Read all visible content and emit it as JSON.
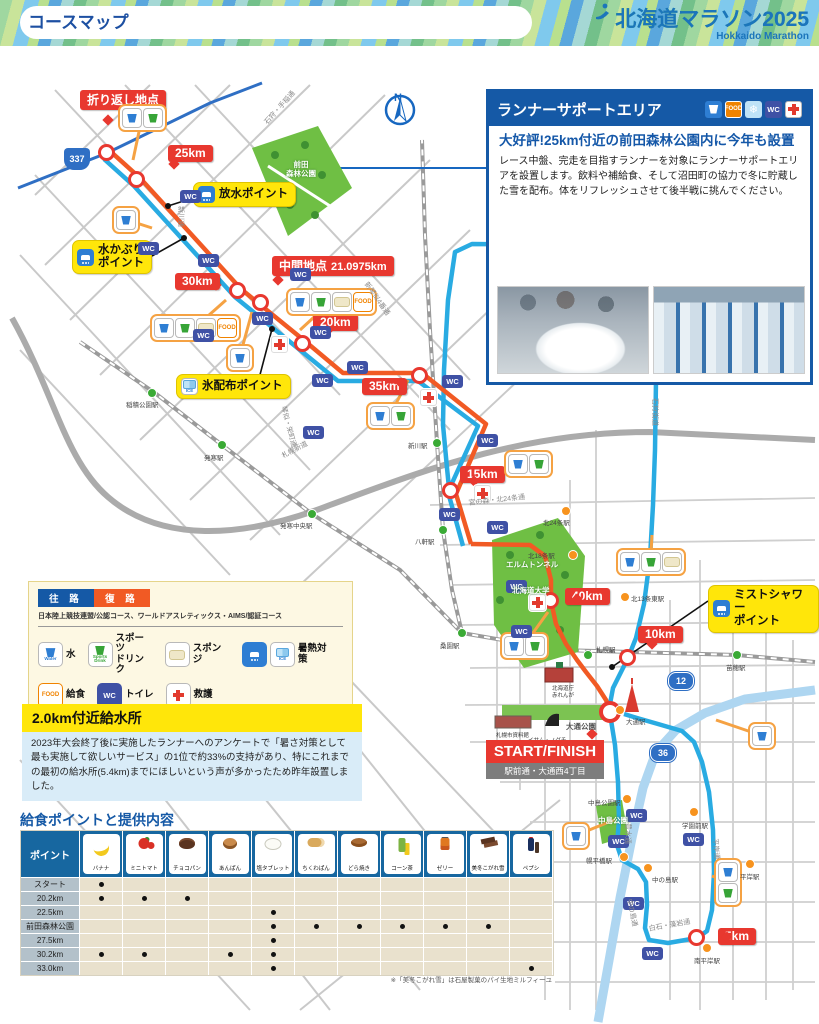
{
  "colors": {
    "course_outbound": "#29abe2",
    "course_return": "#f15a24",
    "marker_red": "#e8382f",
    "brand_blue": "#1559a6",
    "highlight_yellow": "#ffe60a",
    "park_green": "#6fbf44"
  },
  "header": {
    "title": "コースマップ",
    "logo_title": "北海道マラソン2025",
    "logo_subtitle": "Hokkaido Marathon"
  },
  "support_box": {
    "title": "ランナーサポートエリア",
    "headline": "大好評!25km付近の前田森林公園内に今年も設置",
    "body": "レース中盤、完走を目指すランナーを対象にランナーサポートエリアを設置します。飲料や補給食、そして沼田町の協力で冬に貯蔵した雪を配布。体をリフレッシュさせて後半戦に挑んでください。"
  },
  "legend": {
    "outbound_label": "往 路",
    "return_label": "復 路",
    "certification": "日本陸上競技連盟/公認コース、ワールドアスレティックス・AIMS/認証コース",
    "items": [
      {
        "icons": [
          "water"
        ],
        "label": "水"
      },
      {
        "icons": [
          "drink"
        ],
        "label": "スポーツ\nドリンク"
      },
      {
        "icons": [
          "sponge"
        ],
        "label": "スポンジ"
      },
      {
        "icons": [
          "shower",
          "ice"
        ],
        "label": "暑熱対策"
      },
      {
        "icons": [
          "food"
        ],
        "label": "給食"
      },
      {
        "icons": [
          "wc"
        ],
        "label": "トイレ"
      },
      {
        "icons": [
          "aid"
        ],
        "label": "救護"
      }
    ]
  },
  "water_station_box": {
    "title": "2.0km付近給水所",
    "body": "2023年大会終了後に実施したランナーへのアンケートで「暑さ対策として最も実施して欲しいサービス」の1位で約33%の支持があり、特にこれまでの最初の給水所(5.4km)までにほしいという声が多かったため昨年設置しました。"
  },
  "food_table": {
    "title": "給食ポイントと提供内容",
    "point_header": "ポイント",
    "columns": [
      {
        "id": "banana",
        "label": "バナナ"
      },
      {
        "id": "tomato",
        "label": "ミニトマト"
      },
      {
        "id": "chocopan",
        "label": "チョコパン"
      },
      {
        "id": "anpan",
        "label": "あんぱん"
      },
      {
        "id": "salt",
        "label": "塩タブレット"
      },
      {
        "id": "chikuwa",
        "label": "ちくわぱん"
      },
      {
        "id": "dorayaki",
        "label": "どら焼き"
      },
      {
        "id": "corntea",
        "label": "コーン茶"
      },
      {
        "id": "jelly",
        "label": "ゼリー"
      },
      {
        "id": "mifuyu",
        "label": "美冬こがれ雪"
      },
      {
        "id": "pepsi",
        "label": "ペプシ"
      }
    ],
    "rows": [
      {
        "label": "スタート",
        "dots": [
          0
        ]
      },
      {
        "label": "20.2km",
        "dots": [
          0,
          1,
          2
        ]
      },
      {
        "label": "22.5km",
        "dots": [
          4
        ]
      },
      {
        "label": "前田森林公園",
        "dots": [
          4,
          5,
          6,
          7,
          8,
          9
        ]
      },
      {
        "label": "27.5km",
        "dots": [
          4
        ]
      },
      {
        "label": "30.2km",
        "dots": [
          0,
          1,
          3,
          4
        ]
      },
      {
        "label": "33.0km",
        "dots": [
          4,
          10
        ]
      }
    ],
    "footnote": "※「美冬こがれ雪」は石屋製菓のパイ生地ミルフィーユ"
  },
  "map": {
    "north_label": "N",
    "icon_texts": {
      "water": "Water",
      "drink": "Sports\nDrink",
      "food": "FOOD",
      "wc": "WC",
      "ice": "ICE",
      "snow": "❄"
    },
    "km_markers": [
      {
        "label": "折り返し地点",
        "x": 80,
        "y": 90,
        "cx": 107,
        "cy": 153
      },
      {
        "label": "25km",
        "x": 168,
        "y": 145,
        "cx": 137,
        "cy": 180
      },
      {
        "label": "30km",
        "x": 175,
        "y": 273,
        "cx": 238,
        "cy": 291
      },
      {
        "label": "20km",
        "x": 313,
        "y": 314,
        "cx": 303,
        "cy": 344
      },
      {
        "label": "35km",
        "x": 362,
        "y": 378,
        "cx": 420,
        "cy": 376
      },
      {
        "label": "15km",
        "x": 460,
        "y": 466,
        "cx": 451,
        "cy": 491
      },
      {
        "label": "40km",
        "x": 565,
        "y": 588,
        "cx": 551,
        "cy": 601
      },
      {
        "label": "10km",
        "x": 638,
        "y": 626,
        "cx": 628,
        "cy": 658
      },
      {
        "label": "5km",
        "x": 718,
        "y": 928,
        "cx": 697,
        "cy": 938
      }
    ],
    "mid_marker": {
      "label": "中間地点",
      "value": "21.0975km",
      "x": 272,
      "y": 256,
      "cx": 261,
      "cy": 303
    },
    "start_finish": {
      "label": "START/FINISH",
      "sub": "駅前通・大通西4丁目",
      "x": 486,
      "y": 740,
      "cx": 610,
      "cy": 712
    },
    "point_labels": [
      {
        "label": "放水ポイント",
        "icon": "shower",
        "x": 193,
        "y": 182,
        "tx": 168,
        "ty": 206
      },
      {
        "label": "水かぶり\nポイント",
        "icon": "shower",
        "x": 72,
        "y": 240,
        "tx": 184,
        "ty": 238
      },
      {
        "label": "氷配布ポイント",
        "icon": "ice",
        "x": 176,
        "y": 374,
        "tx": 272,
        "ty": 329
      },
      {
        "label": "ミストシャワー\nポイント",
        "icon": "shower",
        "x": 708,
        "y": 585,
        "tx": 612,
        "ty": 667
      }
    ],
    "route_badges": [
      {
        "label": "337",
        "x": 64,
        "y": 148,
        "shape": "shield"
      },
      {
        "label": "12",
        "x": 668,
        "y": 672,
        "shape": "oval"
      },
      {
        "label": "36",
        "x": 650,
        "y": 744,
        "shape": "oval"
      }
    ],
    "stations": [
      {
        "name": "稲積公園駅",
        "x": 152,
        "y": 393,
        "type": "jr",
        "lx": 126,
        "ly": 399
      },
      {
        "name": "発寒駅",
        "x": 222,
        "y": 445,
        "type": "jr",
        "lx": 204,
        "ly": 452
      },
      {
        "name": "発寒中央駅",
        "x": 312,
        "y": 514,
        "type": "jr",
        "lx": 280,
        "ly": 520
      },
      {
        "name": "新川駅",
        "x": 437,
        "y": 443,
        "type": "jr",
        "lx": 408,
        "ly": 440
      },
      {
        "name": "八軒駅",
        "x": 443,
        "y": 530,
        "type": "jr",
        "lx": 415,
        "ly": 536
      },
      {
        "name": "桑園駅",
        "x": 462,
        "y": 633,
        "type": "jr",
        "lx": 440,
        "ly": 640
      },
      {
        "name": "札幌駅",
        "x": 588,
        "y": 655,
        "type": "jr",
        "lx": 596,
        "ly": 644
      },
      {
        "name": "苗穂駅",
        "x": 737,
        "y": 655,
        "type": "jr",
        "lx": 726,
        "ly": 662
      },
      {
        "name": "北24条駅",
        "x": 566,
        "y": 511,
        "type": "sub",
        "lx": 543,
        "ly": 517
      },
      {
        "name": "北18条駅",
        "x": 573,
        "y": 555,
        "type": "sub",
        "lx": 528,
        "ly": 550
      },
      {
        "name": "北13条東駅",
        "x": 625,
        "y": 597,
        "type": "sub",
        "lx": 631,
        "ly": 593
      },
      {
        "name": "大通駅",
        "x": 620,
        "y": 710,
        "type": "sub",
        "lx": 626,
        "ly": 716
      },
      {
        "name": "中島公園駅",
        "x": 627,
        "y": 799,
        "type": "sub",
        "lx": 588,
        "ly": 797
      },
      {
        "name": "幌平橋駅",
        "x": 624,
        "y": 857,
        "type": "sub",
        "lx": 586,
        "ly": 855
      },
      {
        "name": "中の島駅",
        "x": 648,
        "y": 868,
        "type": "sub",
        "lx": 652,
        "ly": 874
      },
      {
        "name": "学園前駅",
        "x": 694,
        "y": 812,
        "type": "sub",
        "lx": 682,
        "ly": 820
      },
      {
        "name": "平岸駅",
        "x": 750,
        "y": 864,
        "type": "sub",
        "lx": 740,
        "ly": 871
      },
      {
        "name": "南平岸駅",
        "x": 707,
        "y": 948,
        "type": "sub",
        "lx": 694,
        "ly": 955
      }
    ],
    "road_labels": [
      {
        "label": "石狩・手稲通",
        "x": 262,
        "y": 120,
        "r": -48
      },
      {
        "label": "新川通",
        "x": 186,
        "y": 206,
        "r": 90
      },
      {
        "label": "新琴似4番通",
        "x": 370,
        "y": 280,
        "r": 55
      },
      {
        "label": "琴似・栄町通",
        "x": 288,
        "y": 405,
        "r": 75
      },
      {
        "label": "札幌新道",
        "x": 280,
        "y": 452,
        "r": -28
      },
      {
        "label": "宮の森・北24条通",
        "x": 468,
        "y": 498,
        "r": -6
      },
      {
        "label": "石狩街道",
        "x": 660,
        "y": 398,
        "r": 90
      },
      {
        "label": "豊水通",
        "x": 633,
        "y": 823,
        "r": 90
      },
      {
        "label": "平岸通",
        "x": 720,
        "y": 838,
        "r": 85
      },
      {
        "label": "中の島通",
        "x": 634,
        "y": 898,
        "r": 78
      },
      {
        "label": "白石・藻岩通",
        "x": 648,
        "y": 924,
        "r": -10
      }
    ],
    "park_labels": [
      {
        "label": "前田\n森林公園",
        "x": 286,
        "y": 160,
        "dark": false
      },
      {
        "label": "エルムトンネル",
        "x": 506,
        "y": 560,
        "dark": false
      },
      {
        "label": "北海道大学",
        "x": 512,
        "y": 586,
        "dark": false
      },
      {
        "label": "中島公園",
        "x": 598,
        "y": 816,
        "dark": false
      },
      {
        "label": "大通公園",
        "x": 566,
        "y": 722,
        "dark": true
      }
    ],
    "building_labels": [
      {
        "label": "北海道庁\n赤れんが",
        "x": 552,
        "y": 686
      },
      {
        "label": "札幌市資料館",
        "x": 496,
        "y": 733
      },
      {
        "label": "イサム・ノグチ\nブラックスライド・マントラ",
        "x": 528,
        "y": 738
      }
    ],
    "clusters": [
      {
        "x": 118,
        "y": 104,
        "icons": [
          "water",
          "drink"
        ],
        "tx": 133,
        "ty": 160
      },
      {
        "x": 112,
        "y": 206,
        "icons": [
          "water"
        ],
        "tx": 152,
        "ty": 228
      },
      {
        "x": 150,
        "y": 314,
        "icons": [
          "water",
          "drink",
          "sponge",
          "food"
        ],
        "tx": 226,
        "ty": 300
      },
      {
        "x": 286,
        "y": 288,
        "icons": [
          "water",
          "drink",
          "sponge",
          "food"
        ],
        "tx": 300,
        "ty": 330
      },
      {
        "x": 226,
        "y": 344,
        "icons": [
          "water"
        ],
        "tx": 252,
        "ty": 312
      },
      {
        "x": 366,
        "y": 402,
        "icons": [
          "water",
          "drink"
        ],
        "tx": 408,
        "ty": 380
      },
      {
        "x": 504,
        "y": 450,
        "icons": [
          "water",
          "drink"
        ],
        "tx": 470,
        "ty": 478
      },
      {
        "x": 616,
        "y": 548,
        "icons": [
          "water",
          "drink",
          "sponge"
        ],
        "tx": 652,
        "ty": 535
      },
      {
        "x": 500,
        "y": 632,
        "icons": [
          "water",
          "drink"
        ],
        "tx": 548,
        "ty": 612
      },
      {
        "x": 562,
        "y": 822,
        "icons": [
          "water"
        ],
        "tx": 614,
        "ty": 820
      },
      {
        "x": 714,
        "y": 858,
        "icons": [
          "water",
          "drink"
        ],
        "vertical": true,
        "tx": 712,
        "ty": 876
      },
      {
        "x": 748,
        "y": 722,
        "icons": [
          "water"
        ],
        "tx": 716,
        "ty": 720
      }
    ],
    "wc_positions": [
      [
        190,
        196
      ],
      [
        148,
        248
      ],
      [
        208,
        260
      ],
      [
        300,
        274
      ],
      [
        262,
        318
      ],
      [
        320,
        332
      ],
      [
        203,
        335
      ],
      [
        357,
        367
      ],
      [
        322,
        380
      ],
      [
        452,
        381
      ],
      [
        487,
        440
      ],
      [
        313,
        432
      ],
      [
        449,
        514
      ],
      [
        497,
        527
      ],
      [
        516,
        586
      ],
      [
        521,
        631
      ],
      [
        636,
        815
      ],
      [
        618,
        841
      ],
      [
        693,
        839
      ],
      [
        652,
        953
      ],
      [
        633,
        903
      ]
    ],
    "aid_positions": [
      [
        278,
        343
      ],
      [
        427,
        396
      ],
      [
        481,
        492
      ],
      [
        536,
        601
      ]
    ]
  }
}
